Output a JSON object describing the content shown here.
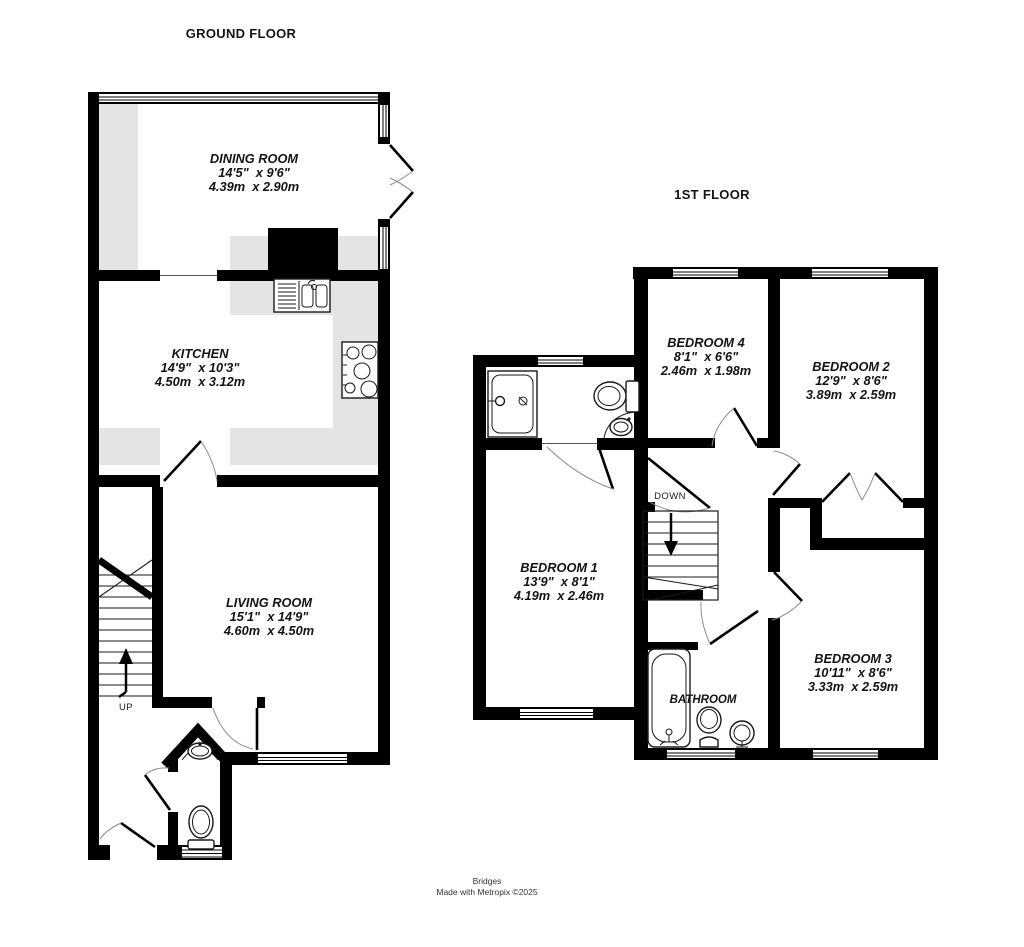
{
  "ground_floor": {
    "title": "GROUND FLOOR",
    "stair_label": "UP",
    "rooms": {
      "dining_room": {
        "name": "DINING ROOM",
        "imperial": "14'5\"  x 9'6\"",
        "metric": "4.39m  x 2.90m"
      },
      "kitchen": {
        "name": "KITCHEN",
        "imperial": "14'9\"  x 10'3\"",
        "metric": "4.50m  x 3.12m"
      },
      "living_room": {
        "name": "LIVING ROOM",
        "imperial": "15'1\"  x 14'9\"",
        "metric": "4.60m  x 4.50m"
      }
    }
  },
  "first_floor": {
    "title": "1ST FLOOR",
    "stair_label": "DOWN",
    "rooms": {
      "bedroom_1": {
        "name": "BEDROOM 1",
        "imperial": "13'9\"  x 8'1\"",
        "metric": "4.19m  x 2.46m"
      },
      "bedroom_2": {
        "name": "BEDROOM 2",
        "imperial": "12'9\"  x 8'6\"",
        "metric": "3.89m  x 2.59m"
      },
      "bedroom_3": {
        "name": "BEDROOM 3",
        "imperial": "10'11\"  x 8'6\"",
        "metric": "3.33m  x 2.59m"
      },
      "bedroom_4": {
        "name": "BEDROOM 4",
        "imperial": "8'1\"  x 6'6\"",
        "metric": "2.46m  x 1.98m"
      },
      "bathroom": {
        "name": "BATHROOM"
      }
    }
  },
  "footer": {
    "line1": "Bridges",
    "line2": "Made with Metropix ©2025"
  },
  "colors": {
    "wall": "#000000",
    "counter": "#e4e4e4",
    "text": "#141414",
    "footer_text": "#333333"
  }
}
